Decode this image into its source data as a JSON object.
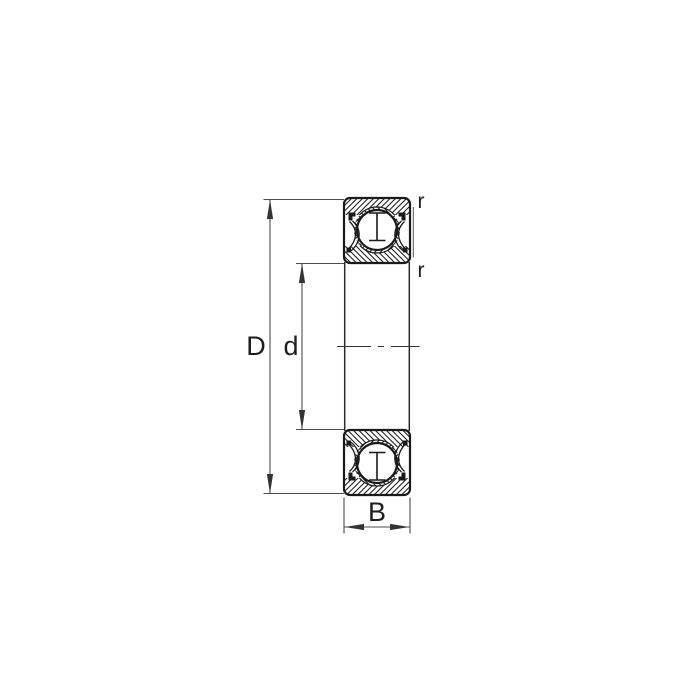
{
  "diagram": {
    "labels": {
      "outer_diameter": "D",
      "bore_diameter": "d",
      "width": "B",
      "chamfer_radius_top": "r",
      "chamfer_radius_bottom": "r"
    },
    "colors": {
      "background": "#ffffff",
      "outline": "#1a1a1a",
      "dimension_line": "#4d4d4d",
      "arrow": "#333333",
      "label_text": "#1e1e1e"
    }
  }
}
